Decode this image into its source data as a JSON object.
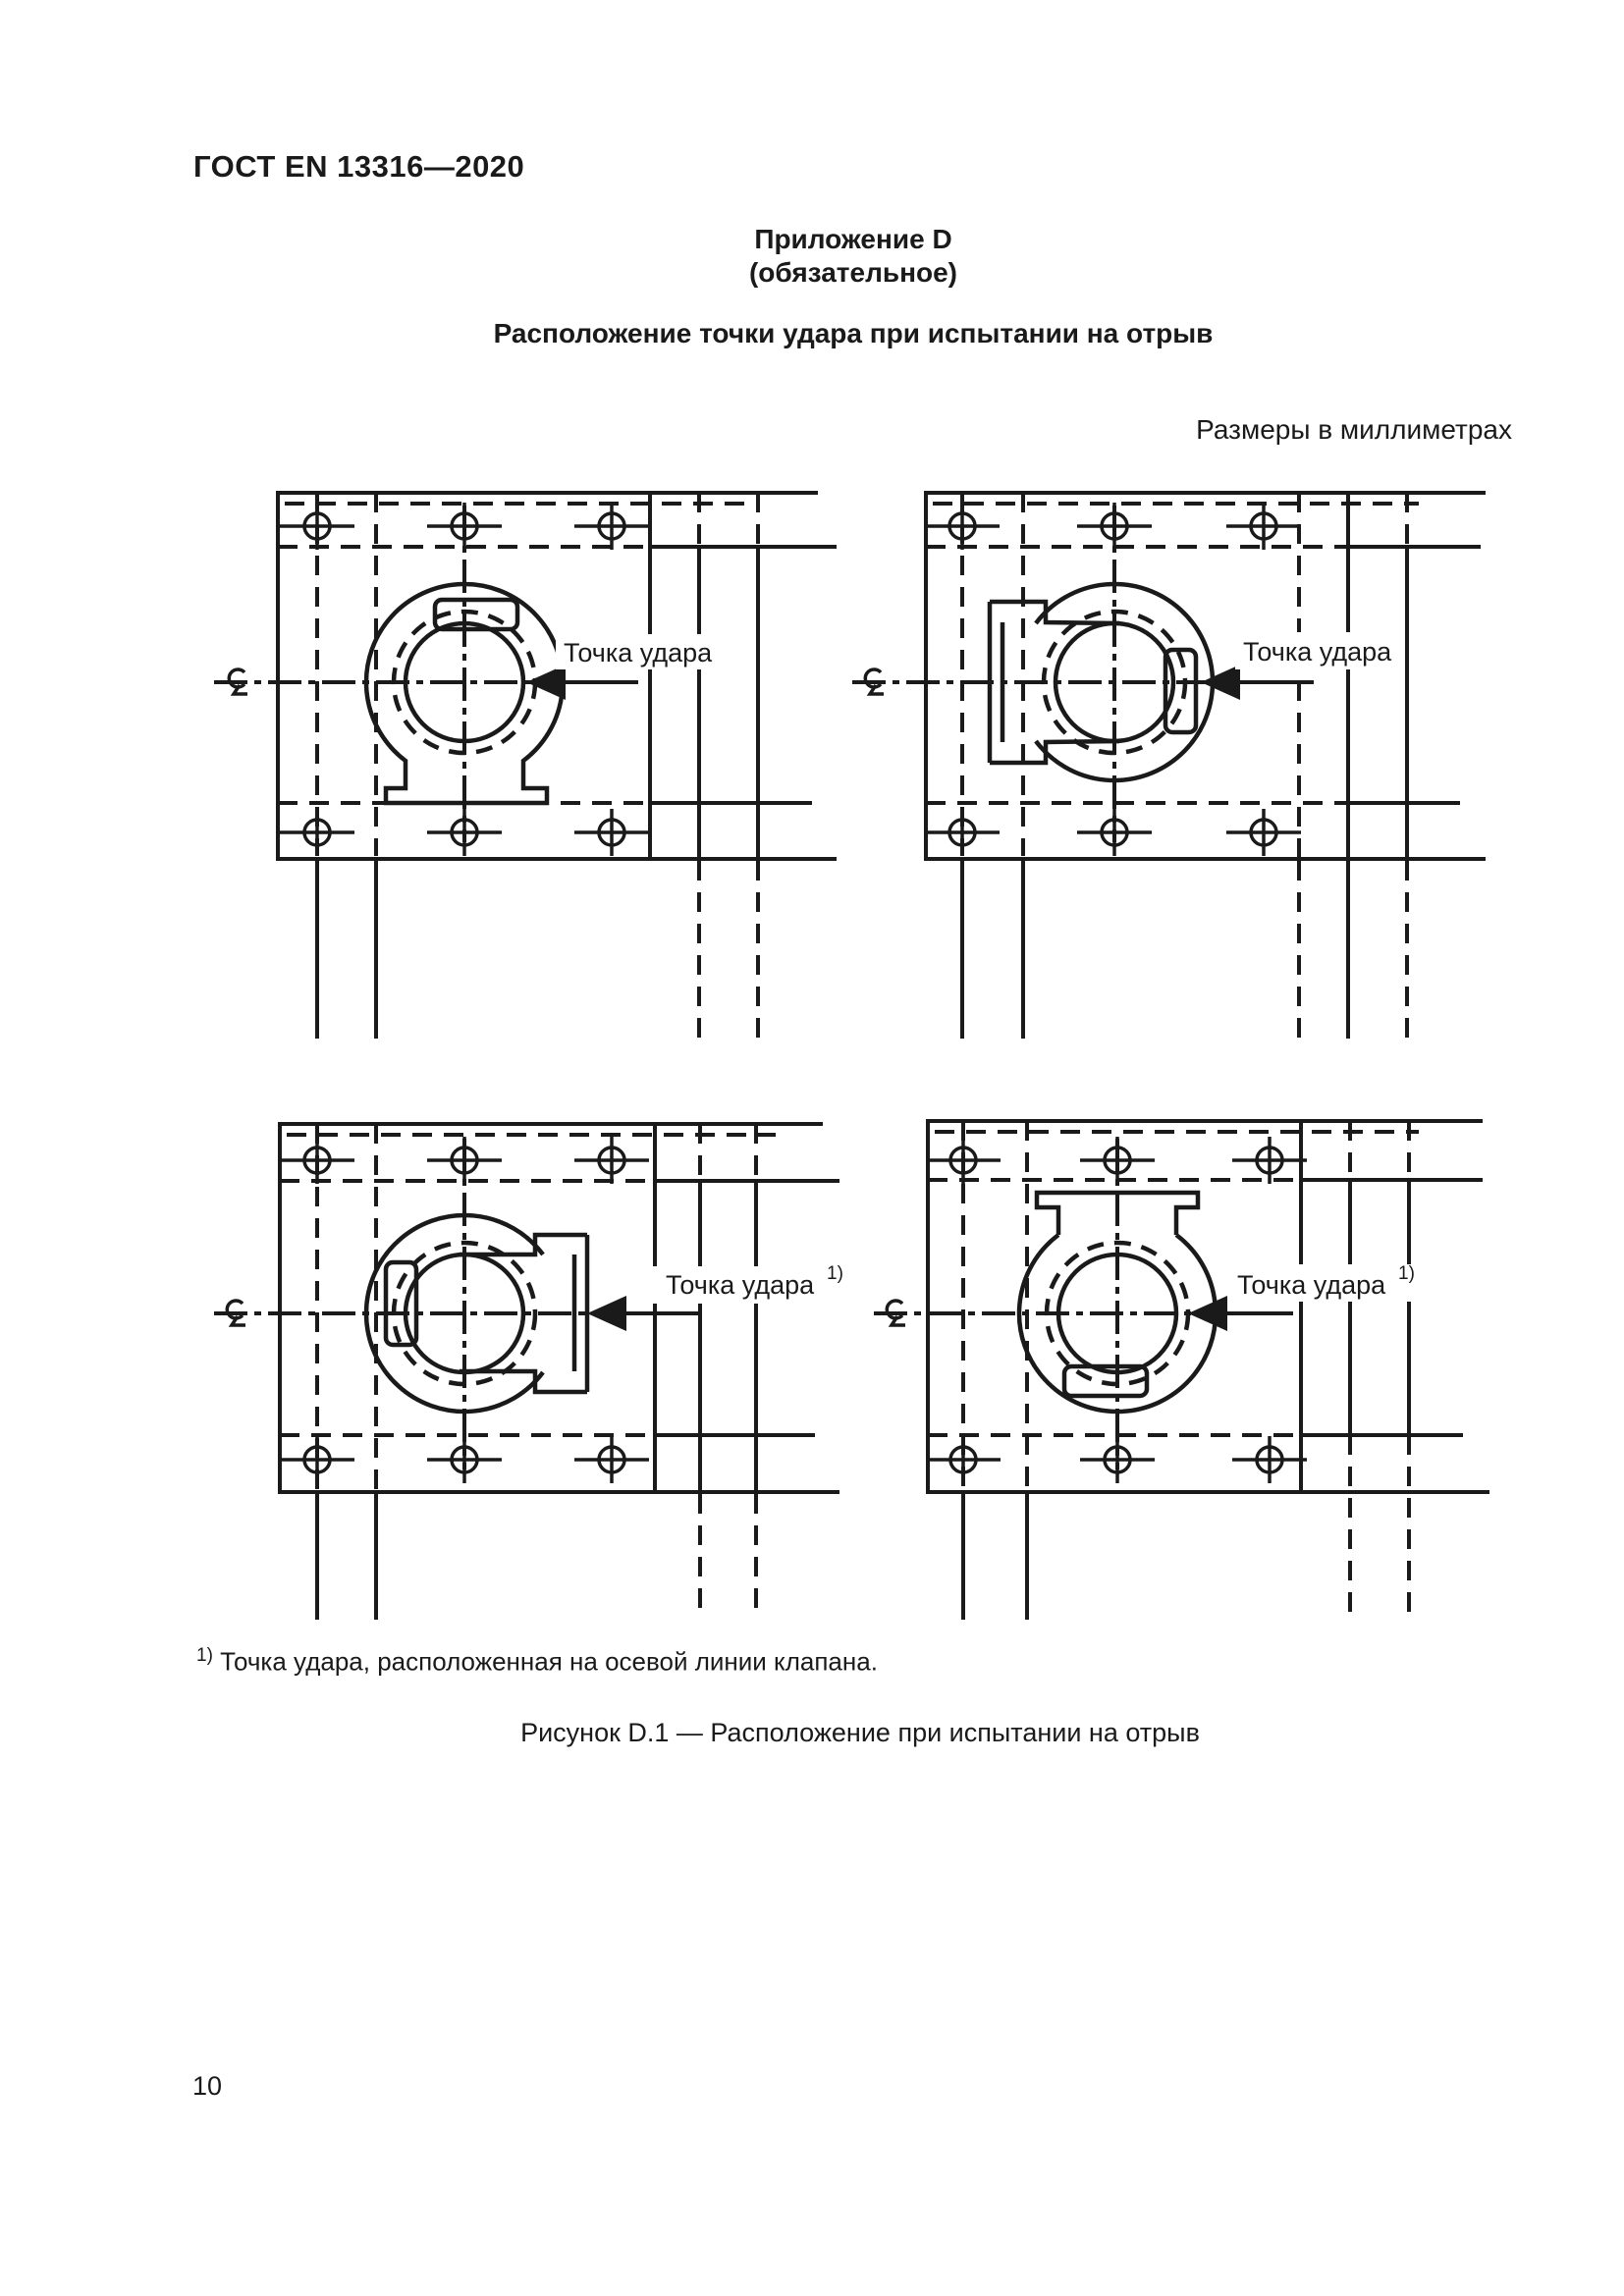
{
  "page": {
    "header": "ГОСТ EN 13316—2020",
    "number": "10"
  },
  "appendix": {
    "label": "Приложение D",
    "note": "(обязательное)",
    "title": "Расположение точки удара при испытании на отрыв",
    "units": "Размеры в миллиметрах"
  },
  "figure": {
    "impact_label": "Точка удара",
    "footnote_marker": "1)",
    "footnote_text": "Точка удара, расположенная на осевой линии клапана.",
    "caption": "Рисунок D.1 — Расположение при испытании на отрыв",
    "icons": {
      "centerline_symbol": "centreline-symbol",
      "bolt": "bolt-hole-symbol",
      "arrow": "impact-arrow"
    },
    "colors": {
      "line": "#1a1a1a",
      "background": "#ffffff"
    }
  }
}
